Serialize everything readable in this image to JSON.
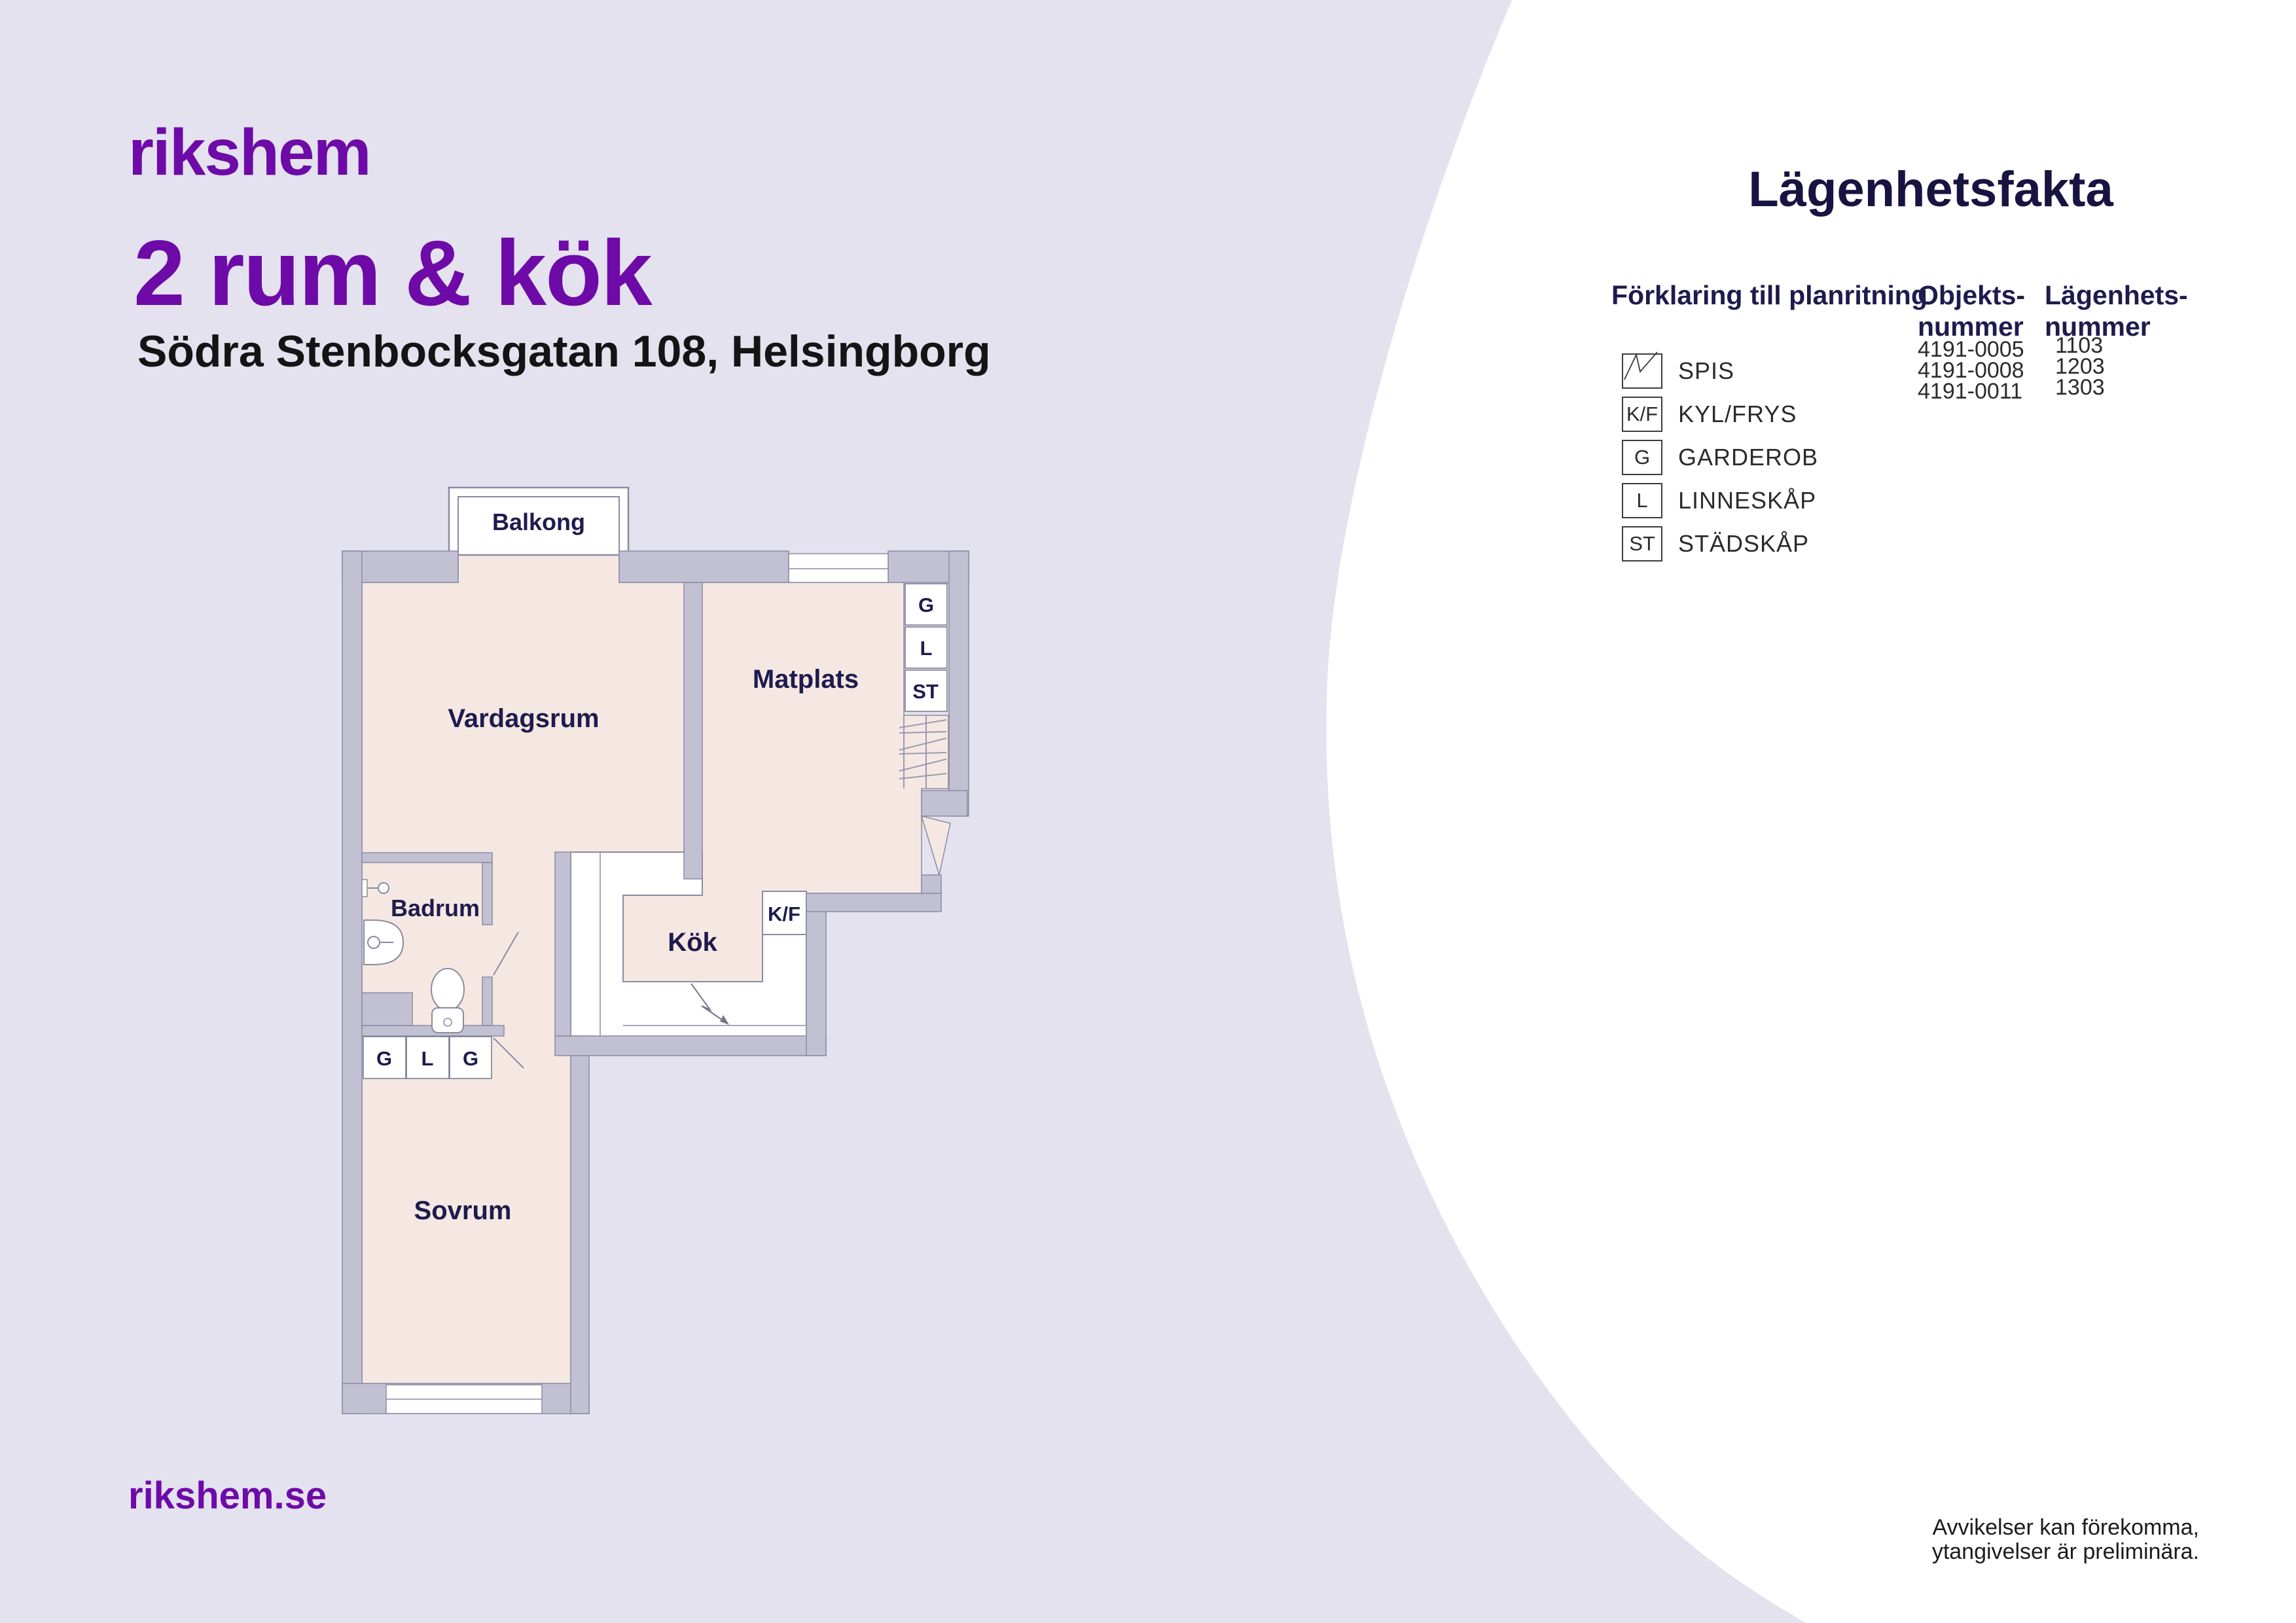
{
  "colors": {
    "background_lavender": "#e3e2ee",
    "panel_white": "#ffffff",
    "wall_gray": "#c2c1d3",
    "wall_outline": "#8b8aa4",
    "floor_pink": "#f5e8e2",
    "brand_purple": "#6e0aa8",
    "navy": "#1e1b4e",
    "heading_navy": "#171442",
    "text_black": "#141414"
  },
  "header": {
    "logo": "rikshem",
    "title": "2 rum & kök",
    "address": "Södra Stenbocksgatan 108, Helsingborg"
  },
  "footer": {
    "website": "rikshem.se"
  },
  "plan": {
    "rooms": {
      "balcony": "Balkong",
      "living": "Vardagsrum",
      "dining": "Matplats",
      "bathroom": "Badrum",
      "kitchen": "Kök",
      "bedroom": "Sovrum"
    },
    "fridge": "K/F",
    "closets_right": [
      "G",
      "L",
      "ST"
    ],
    "closets_hall": [
      "G",
      "L",
      "G"
    ]
  },
  "facts": {
    "title": "Lägenhetsfakta",
    "legend_title": "Förklaring till planritning",
    "legend": [
      {
        "icon": "spis-icon",
        "symbol": "",
        "label": "SPIS"
      },
      {
        "icon": "box",
        "symbol": "K/F",
        "label": "KYL/FRYS"
      },
      {
        "icon": "box",
        "symbol": "G",
        "label": "GARDEROB"
      },
      {
        "icon": "box",
        "symbol": "L",
        "label": "LINNESKÅP"
      },
      {
        "icon": "box",
        "symbol": "ST",
        "label": "STÄDSKÅP"
      }
    ],
    "columns": {
      "object": {
        "line1": "Objekts-",
        "line2": "nummer",
        "values": [
          "4191-0005",
          "4191-0008",
          "4191-0011"
        ]
      },
      "apartment": {
        "line1": "Lägenhets-",
        "line2": "nummer",
        "values": [
          "1103",
          "1203",
          "1303"
        ]
      }
    }
  },
  "disclaimer": {
    "line1": "Avvikelser kan förekomma,",
    "line2": "ytangivelser är preliminära."
  }
}
